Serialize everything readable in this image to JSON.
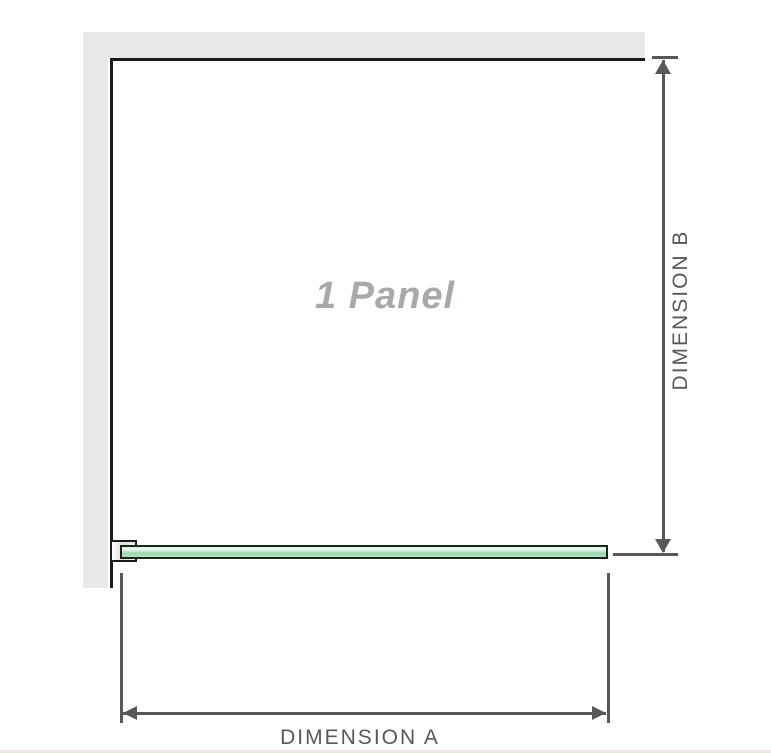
{
  "diagram": {
    "panel_label": "1 Panel",
    "dimension_a_label": "DIMENSION A",
    "dimension_b_label": "DIMENSION B"
  },
  "colors": {
    "wall": "#e8e8e8",
    "line": "#1a1a1a",
    "dim": "#58585a",
    "label": "#a7a9ac",
    "glass-edge": "#16261b",
    "glass-light": "#ddf1e0",
    "glass-mid": "#9dd5ad",
    "divider": "#f0e5e2"
  }
}
